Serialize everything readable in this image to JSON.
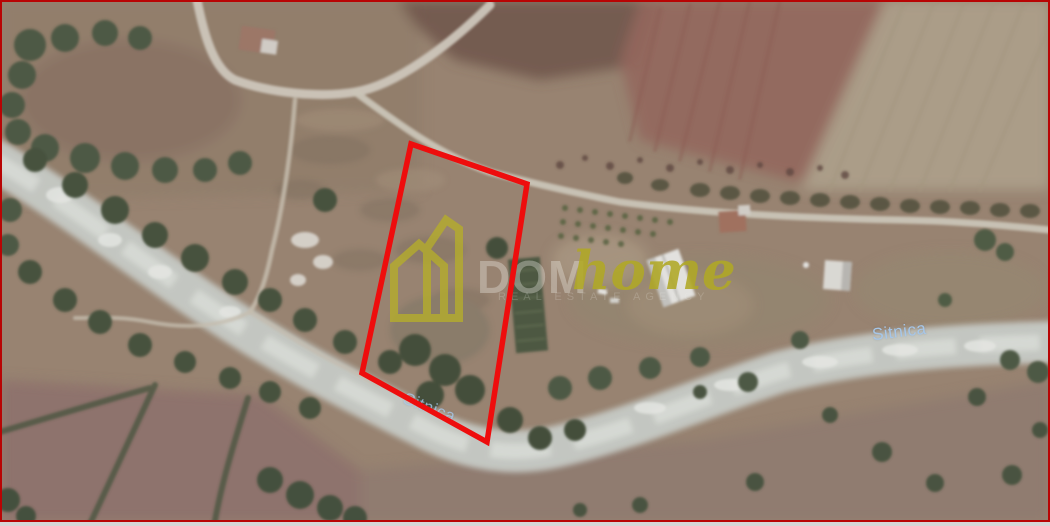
{
  "frame": {
    "border_color": "#b80404",
    "bottom_strip_color": "#d6d6d6"
  },
  "map": {
    "imagery_type": "satellite",
    "labels": {
      "river_east": "Sitnica",
      "river_west": "Sitnica"
    },
    "watermark": {
      "brand_prefix": "DOM",
      "brand_suffix": "home",
      "tagline": "REAL ESTATE AGENCY",
      "brand_color": "#b2aa28"
    },
    "parcel": {
      "outline_color": "#ee0d0d",
      "vertices": [
        [
          411,
          144
        ],
        [
          527,
          184
        ],
        [
          487,
          442
        ],
        [
          362,
          373
        ]
      ]
    }
  }
}
